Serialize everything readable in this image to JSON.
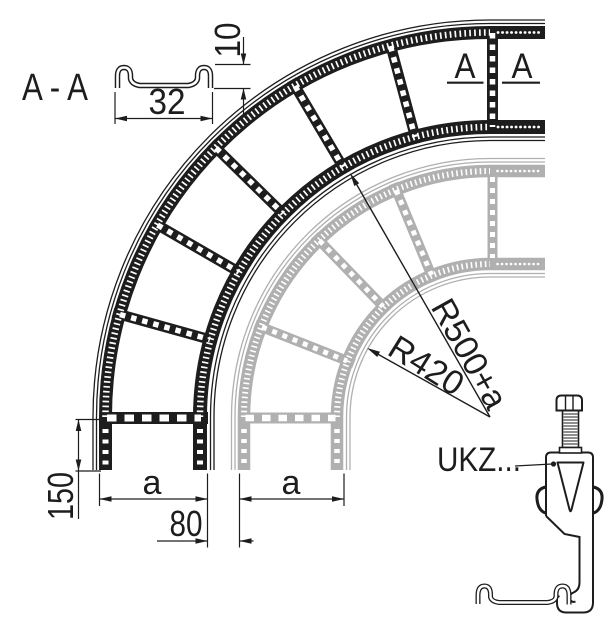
{
  "section_view": {
    "label": "A - A",
    "width_value": "32",
    "height_value": "10"
  },
  "section_cut": {
    "left_letter": "A",
    "right_letter": "A"
  },
  "radii": {
    "outer": "R500+a",
    "inner": "R420"
  },
  "dims": {
    "leg_length": "150",
    "main_width": "a",
    "ghost_width": "a",
    "rail_offset": "80"
  },
  "clamp": {
    "label": "UKZ..."
  },
  "colors": {
    "ink": "#1d1d1d",
    "ghost": "#b0b0b0",
    "background": "#ffffff"
  }
}
